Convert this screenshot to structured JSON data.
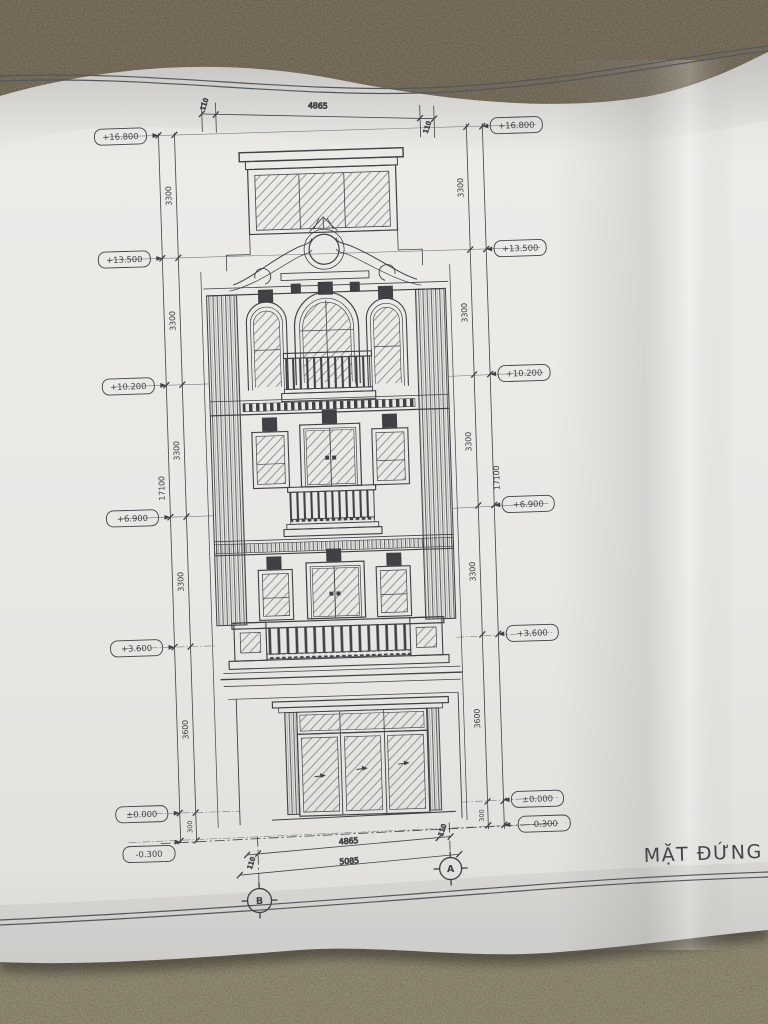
{
  "drawing": {
    "title": "MẶT ĐỨNG TRỤ",
    "elevations_left": [
      "+16.800",
      "+13.500",
      "+10.200",
      "+6.900",
      "+3.600",
      "±0.000",
      "-0.300"
    ],
    "elevations_right": [
      "+16.800",
      "+13.500",
      "+10.200",
      "+6.900",
      "+3.600",
      "±0.000",
      "-0.300"
    ],
    "floor_dims_left": [
      "3300",
      "3300",
      "3300",
      "3300",
      "3600",
      "300"
    ],
    "floor_dims_right": [
      "3300",
      "3300",
      "3300",
      "3300",
      "3600",
      "300"
    ],
    "overall_dim_left": "17100",
    "overall_dim_right": "17100",
    "top_dims": {
      "left_offset": "110",
      "width": "4865",
      "right_offset": "110"
    },
    "bottom_dims": {
      "left_offset": "110",
      "width": "4865",
      "right_offset": "110",
      "total": "5085"
    },
    "grid": {
      "left": "B",
      "right": "A"
    }
  },
  "colors": {
    "ink": "#3f4145",
    "paper": "#e8e7e4",
    "dirt": "#473f33"
  }
}
